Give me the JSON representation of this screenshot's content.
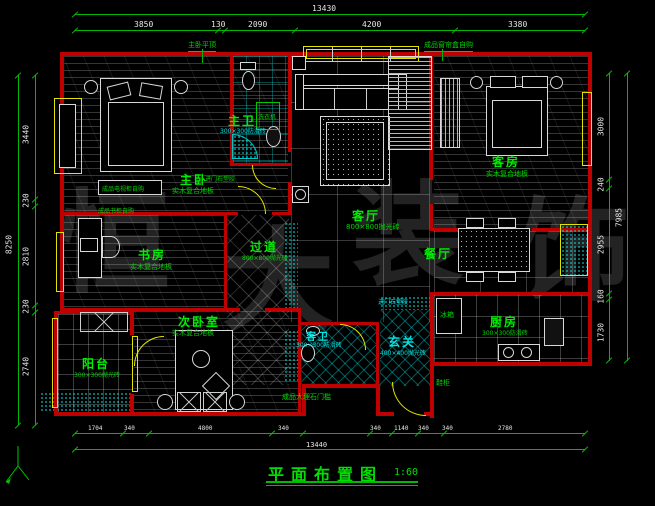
{
  "title": {
    "name": "平面布置图",
    "scale": "1:60"
  },
  "dimensions": {
    "top": {
      "total": "13430",
      "segs": [
        "3850",
        "130",
        "2090",
        "4200",
        "3380"
      ]
    },
    "left": {
      "total": "8250",
      "segs": [
        "3440",
        "230",
        "2810",
        "230",
        "2740"
      ]
    },
    "right": {
      "total": "7985",
      "segs": [
        "3000",
        "240",
        "2955",
        "160",
        "1730"
      ]
    },
    "bottom": {
      "total": "13440",
      "segs": [
        "1704",
        "340",
        "4800",
        "340",
        "340",
        "1140",
        "340",
        "340",
        "2780"
      ]
    }
  },
  "rooms": {
    "zhuwo": {
      "name": "主卧",
      "material": "实木复合地板"
    },
    "zhuwei": {
      "name": "主卫",
      "material": "300×300防滑砖"
    },
    "keting": {
      "name": "客厅",
      "material": "800×800抛光砖"
    },
    "kefang": {
      "name": "客房",
      "material": "实木复合地板"
    },
    "shufang": {
      "name": "书房",
      "material": "实木复合地板"
    },
    "guodao": {
      "name": "过道",
      "material": "800×800抛光砖"
    },
    "canting": {
      "name": "餐厅"
    },
    "ciwoshi": {
      "name": "次卧室",
      "material": "实木复合地板"
    },
    "yangtai": {
      "name": "阳台",
      "material": "300×300抛光砖"
    },
    "xuanguan": {
      "name": "玄关",
      "material": "400×400抛光砖"
    },
    "chufang": {
      "name": "厨房",
      "material": "300×300防滑砖"
    },
    "kewei": {
      "name": "客卫",
      "material": "300×300防滑砖"
    }
  },
  "annotations": {
    "ceiling": "主卧平顶",
    "curtain_box": "成品窗帘盒自购",
    "tv_cabinet": "成品电视柜自购",
    "bookcase": "成品书柜自购",
    "threshold_plastic": "进门石塑胶",
    "threshold_marble": "成品大理石门槛",
    "shoe_cabinet": "鞋柜",
    "washer": "洗衣机",
    "fridge": "冰箱"
  },
  "watermark": {
    "chars": [
      "恒",
      "大",
      "装",
      "饰"
    ]
  },
  "axis": {
    "label": "Y"
  },
  "colors": {
    "dim_line": "#00b900",
    "label_green": "#00ee00",
    "label_cyan": "#00e5e5",
    "wall_red": "#bf0000",
    "window_yellow": "#e3e300",
    "dim_text": "#e6e6e6"
  }
}
